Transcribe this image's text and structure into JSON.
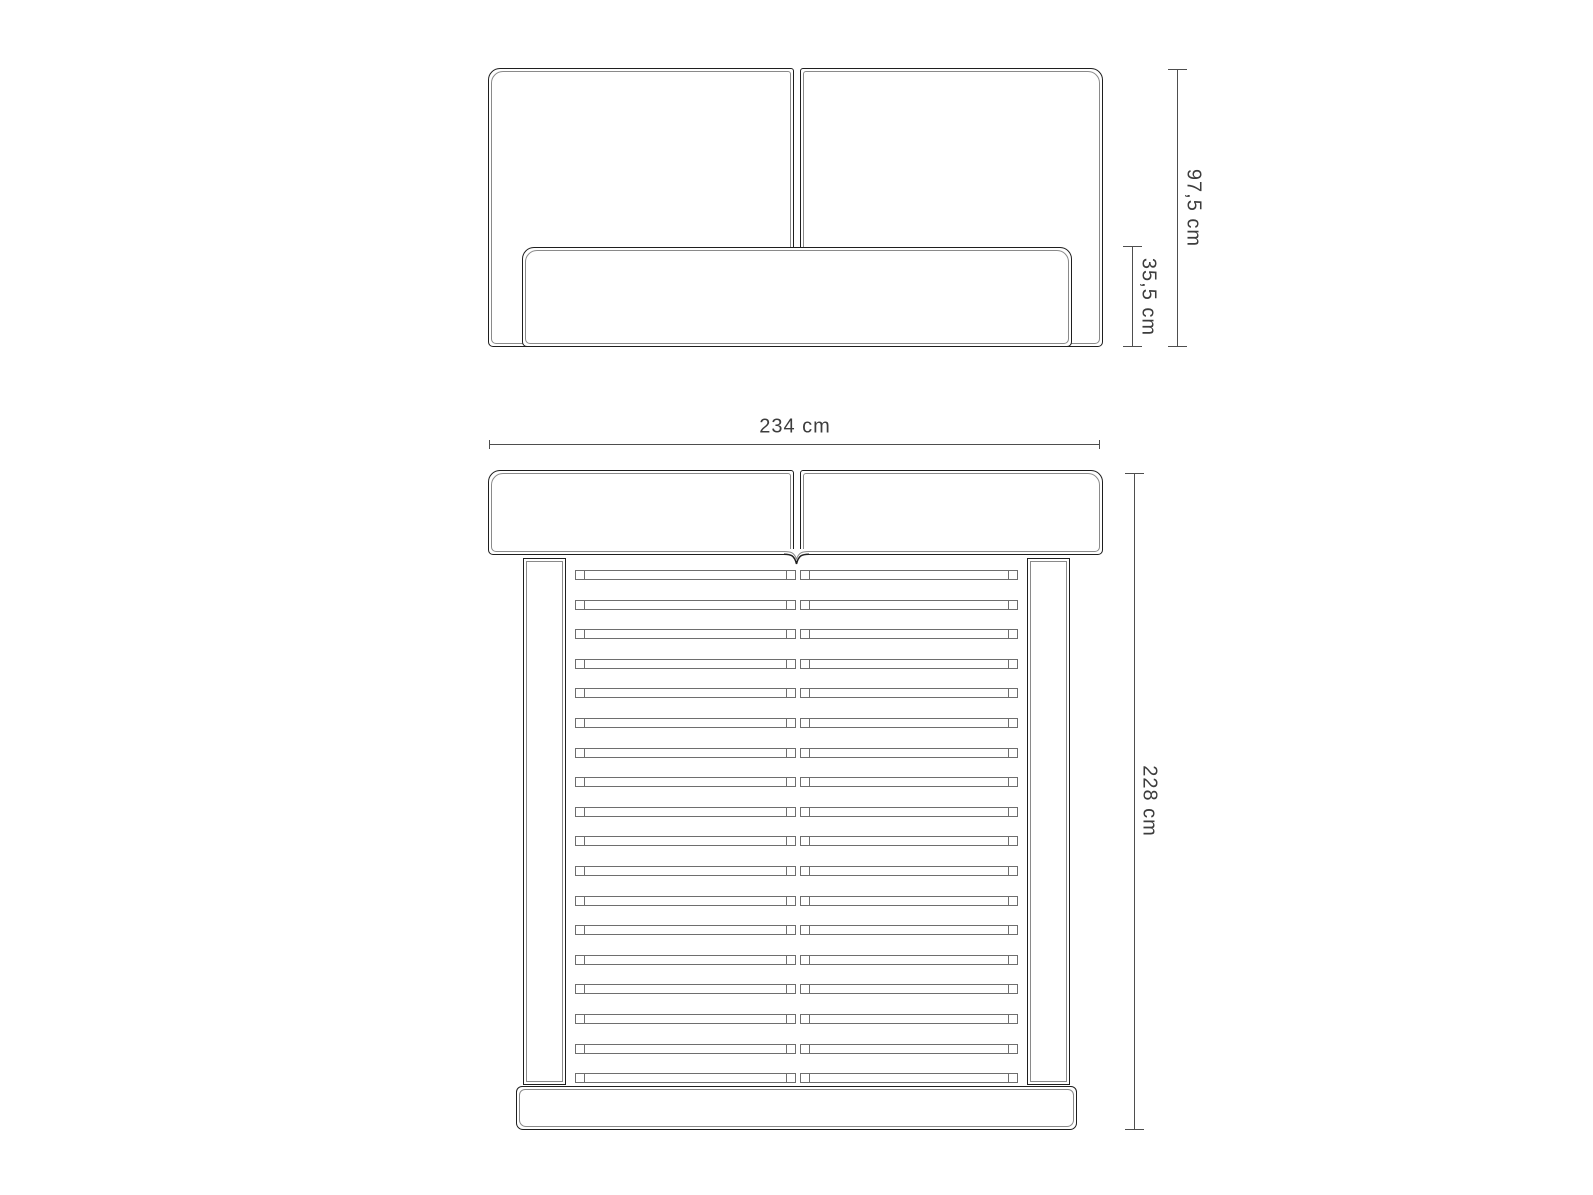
{
  "front_view": {
    "total_height_label": "97,5 cm",
    "base_height_label": "35,5 cm"
  },
  "top_view": {
    "width_label": "234 cm",
    "length_label": "228 cm",
    "slat_rows": 18
  },
  "colors": {
    "outline": "#1f1f1f",
    "inner_line": "#8a8a8a",
    "slat_line": "#6e6e6e",
    "dimension": "#4e4e4e",
    "text": "#3d3d3d",
    "background": "#ffffff"
  }
}
